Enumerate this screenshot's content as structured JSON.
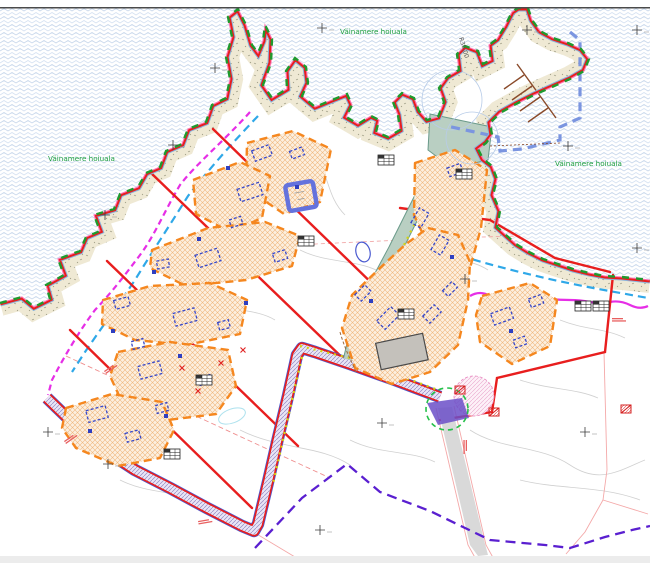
{
  "map": {
    "labels": [
      {
        "id": "protected-area-left",
        "text": "Väinamere hoiuala"
      },
      {
        "id": "protected-area-top",
        "text": "Väinamere hoiuala"
      },
      {
        "id": "protected-area-right",
        "text": "Väinamere hoiuala"
      },
      {
        "id": "harbor-radius",
        "text": "R30,00"
      }
    ],
    "colors": {
      "water_pattern": "#c9d8ec",
      "shore_band": "#efe9d4",
      "plan_boundary_red": "#e81e1e",
      "coast_pink": "#ff70b0",
      "protected_area_green": "#1f9a2e",
      "envelope_orange": "#f5871f",
      "planned_building_blue": "#3848c8",
      "road_teal": "#b9cfc2",
      "road_lavender_hatch": "#968ac2",
      "breakwater_blue": "#7b95e0",
      "jetty_brown": "#8a4a2a",
      "magenta_line": "#e62ee6",
      "cyan_line": "#2fa8e8",
      "purple_dashed": "#5a1fd0",
      "existing_building_gray": "#c4c1bb",
      "road_gray": "#d9d9d9"
    },
    "markers": {
      "info_tables": [
        {
          "x": 386,
          "y": 160
        },
        {
          "x": 464,
          "y": 174
        },
        {
          "x": 306,
          "y": 241
        },
        {
          "x": 406,
          "y": 314
        },
        {
          "x": 204,
          "y": 380
        },
        {
          "x": 172,
          "y": 454
        },
        {
          "x": 583,
          "y": 306
        },
        {
          "x": 601,
          "y": 306
        }
      ],
      "utility_symbols": [
        {
          "x": 460,
          "y": 390
        },
        {
          "x": 494,
          "y": 412
        },
        {
          "x": 626,
          "y": 409
        }
      ],
      "survey_crosses": [
        {
          "x": 173,
          "y": 145
        },
        {
          "x": 105,
          "y": 215
        },
        {
          "x": 322,
          "y": 28
        },
        {
          "x": 527,
          "y": 30
        },
        {
          "x": 568,
          "y": 146
        },
        {
          "x": 382,
          "y": 423
        },
        {
          "x": 108,
          "y": 464
        },
        {
          "x": 320,
          "y": 530
        },
        {
          "x": 585,
          "y": 432
        },
        {
          "x": 637,
          "y": 30
        },
        {
          "x": 637,
          "y": 248
        },
        {
          "x": 48,
          "y": 432
        },
        {
          "x": 215,
          "y": 68
        },
        {
          "x": 465,
          "y": 279
        }
      ],
      "red_x_marks": [
        {
          "x": 182,
          "y": 368
        },
        {
          "x": 198,
          "y": 391
        },
        {
          "x": 221,
          "y": 363
        },
        {
          "x": 243,
          "y": 350
        }
      ],
      "micro_labels": [
        {
          "x": 64,
          "y": 441,
          "r": -35
        },
        {
          "x": 198,
          "y": 521,
          "r": -10
        },
        {
          "x": 467,
          "y": 440,
          "r": 90
        },
        {
          "x": 612,
          "y": 318,
          "r": 0
        },
        {
          "x": 104,
          "y": 371,
          "r": -35
        }
      ]
    }
  }
}
